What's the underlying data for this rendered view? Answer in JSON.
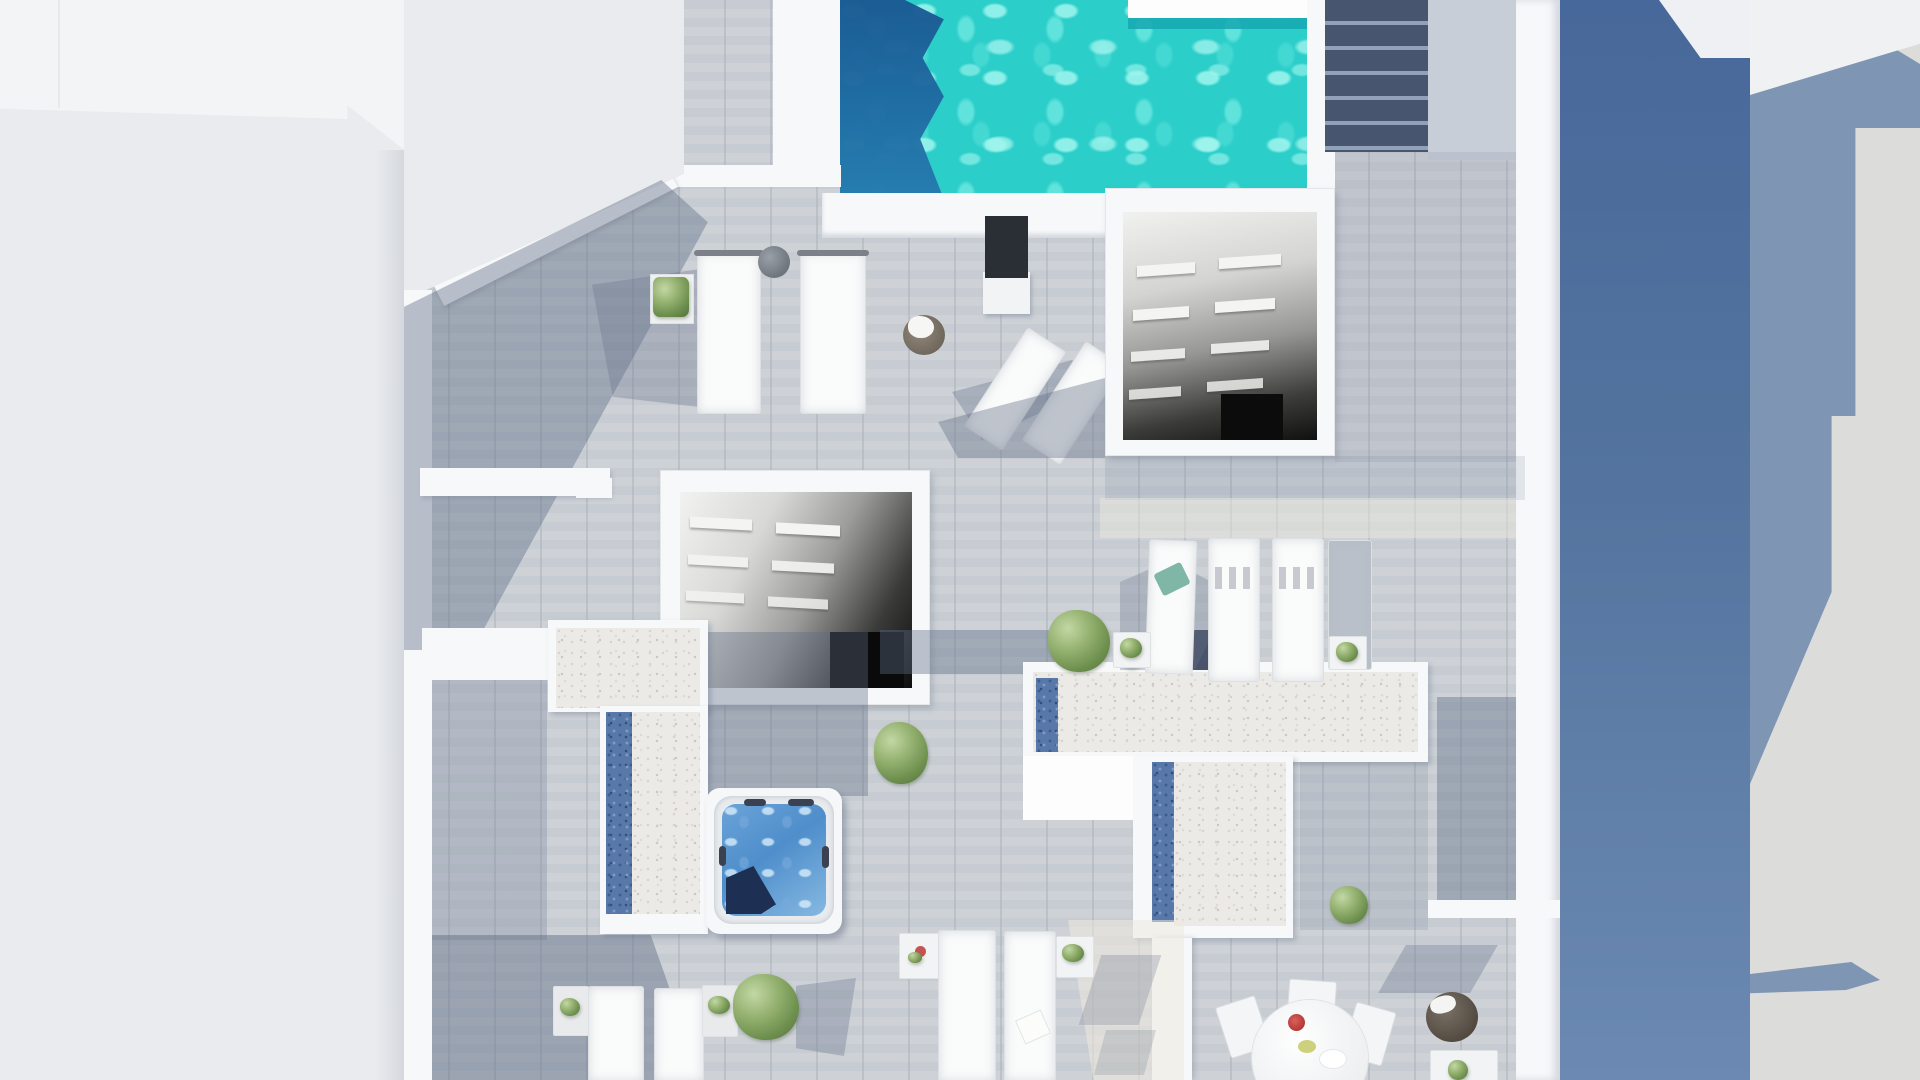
{
  "scene": {
    "description": "Top-down 3D architectural render of a rooftop penthouse terrace between neighboring buildings",
    "view": "plan view (bird's eye)",
    "areas": {
      "pool": {
        "label": "swimming pool",
        "water_color": "#2bcec9",
        "deep_band_color": "#1a5892",
        "corner_platform": "white notch, top-right"
      },
      "top_right_stairs": {
        "label": "external staircase",
        "tread_color": "#47556e"
      },
      "stairwell_upper": {
        "label": "open stairwell to lower floor",
        "walls": "#f7f8fa",
        "interior": "fades to black doorway"
      },
      "stairwell_lower": {
        "label": "second open stairwell",
        "walls": "#f7f8fa",
        "interior": "fades to black"
      },
      "hot_tub": {
        "label": "square hot tub on white platform",
        "water_color": "#4f8ecb",
        "cover_color": "#1d2f52"
      },
      "left_planter": {
        "label": "gravel skylight strip with blue pebble band",
        "gravel": "#eceae6",
        "pebbles": "#5878a9"
      },
      "center_planter": {
        "label": "T-shaped gravel skylight with blue pebble bands",
        "gravel": "#eceae6",
        "pebbles": "#5878a9"
      },
      "deck": {
        "label": "grey timber decking",
        "color": "#cbd0d5"
      }
    },
    "furniture": [
      {
        "name": "double daybeds",
        "count": 2,
        "location": "upper left by pool"
      },
      {
        "name": "angled loungers",
        "count": 2,
        "location": "below pool shower panel"
      },
      {
        "name": "shower panel",
        "color": "#2a2e35",
        "location": "below pool"
      },
      {
        "name": "wicker basket with towel",
        "location": "left of upper stairwell"
      },
      {
        "name": "lounger row",
        "count": 4,
        "location": "right middle",
        "accent_towel": "#7fb6a6"
      },
      {
        "name": "loungers",
        "count": 2,
        "location": "bottom center"
      },
      {
        "name": "loungers",
        "count": 2,
        "location": "bottom left"
      },
      {
        "name": "round dining table with chairs",
        "count_chairs": 3,
        "location": "bottom right",
        "bowl_color": "#c03f3a"
      },
      {
        "name": "wicker pouf",
        "location": "bottom right corner"
      },
      {
        "name": "potted plants",
        "count": 9
      }
    ],
    "surroundings": {
      "left_building": {
        "color": "#e9ebee"
      },
      "right_wall": {
        "color_top": "#47689a",
        "color_bottom": "#6b89b2"
      },
      "far_right_roof": {
        "color": "#dcddda",
        "shadow_color": "#7e95b4"
      }
    }
  },
  "palette": {
    "pool_turquoise": "#2bcec9",
    "pool_deep_blue": "#1a5892",
    "deck_grey": "#cbd0d5",
    "shadow_blue_grey": "#606d86",
    "wall_white": "#f7f8fa",
    "gravel_white": "#eceae6",
    "pebble_blue": "#5878a9",
    "neighbor_blue_wall": "#47689a",
    "plant_green": "#93b06f",
    "tub_blue": "#4f8ecb"
  }
}
